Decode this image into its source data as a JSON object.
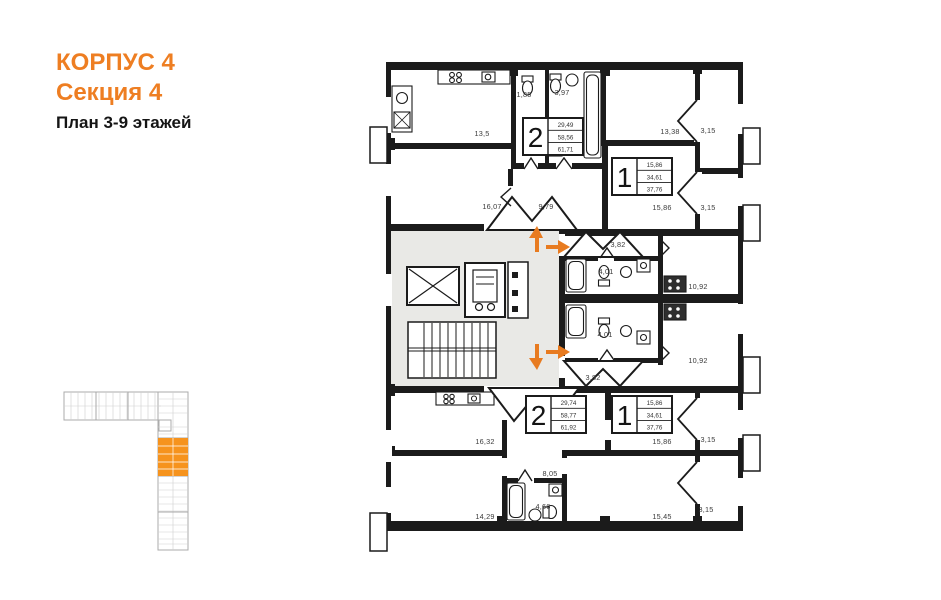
{
  "header": {
    "building": "КОРПУС 4",
    "section": "Секция 4",
    "floors_label": "План 3-9 этажей",
    "accent_color": "#EE7E22"
  },
  "plan": {
    "wall_color": "#1b1b1b",
    "corridor_fill": "#e9e9e6",
    "arrow_color": "#e87b20",
    "apartments": [
      {
        "rooms": "2",
        "living_area": "29,49",
        "area_no_balcony": "58,56",
        "total_area": "61,71"
      },
      {
        "rooms": "1",
        "living_area": "15,86",
        "area_no_balcony": "34,61",
        "total_area": "37,76"
      },
      {
        "rooms": "2",
        "living_area": "29,74",
        "area_no_balcony": "58,77",
        "total_area": "61,92"
      },
      {
        "rooms": "1",
        "living_area": "15,86",
        "area_no_balcony": "34,61",
        "total_area": "37,76"
      }
    ],
    "room_labels": [
      {
        "t": "13,5"
      },
      {
        "t": "1,85"
      },
      {
        "t": "3,97"
      },
      {
        "t": "13,38"
      },
      {
        "t": "3,15"
      },
      {
        "t": "16,07"
      },
      {
        "t": "9,79"
      },
      {
        "t": "15,86"
      },
      {
        "t": "3,15"
      },
      {
        "t": "3,82"
      },
      {
        "t": "4,01"
      },
      {
        "t": "10,92"
      },
      {
        "t": "4,01"
      },
      {
        "t": "10,92"
      },
      {
        "t": "3,82"
      },
      {
        "t": "16,32"
      },
      {
        "t": "15,86"
      },
      {
        "t": "3,15"
      },
      {
        "t": "8,05"
      },
      {
        "t": "4,66"
      },
      {
        "t": "14,29"
      },
      {
        "t": "15,45"
      },
      {
        "t": "3,15"
      }
    ]
  },
  "minimap": {
    "highlight_color": "#f6931d",
    "outline_color": "#ababab"
  }
}
